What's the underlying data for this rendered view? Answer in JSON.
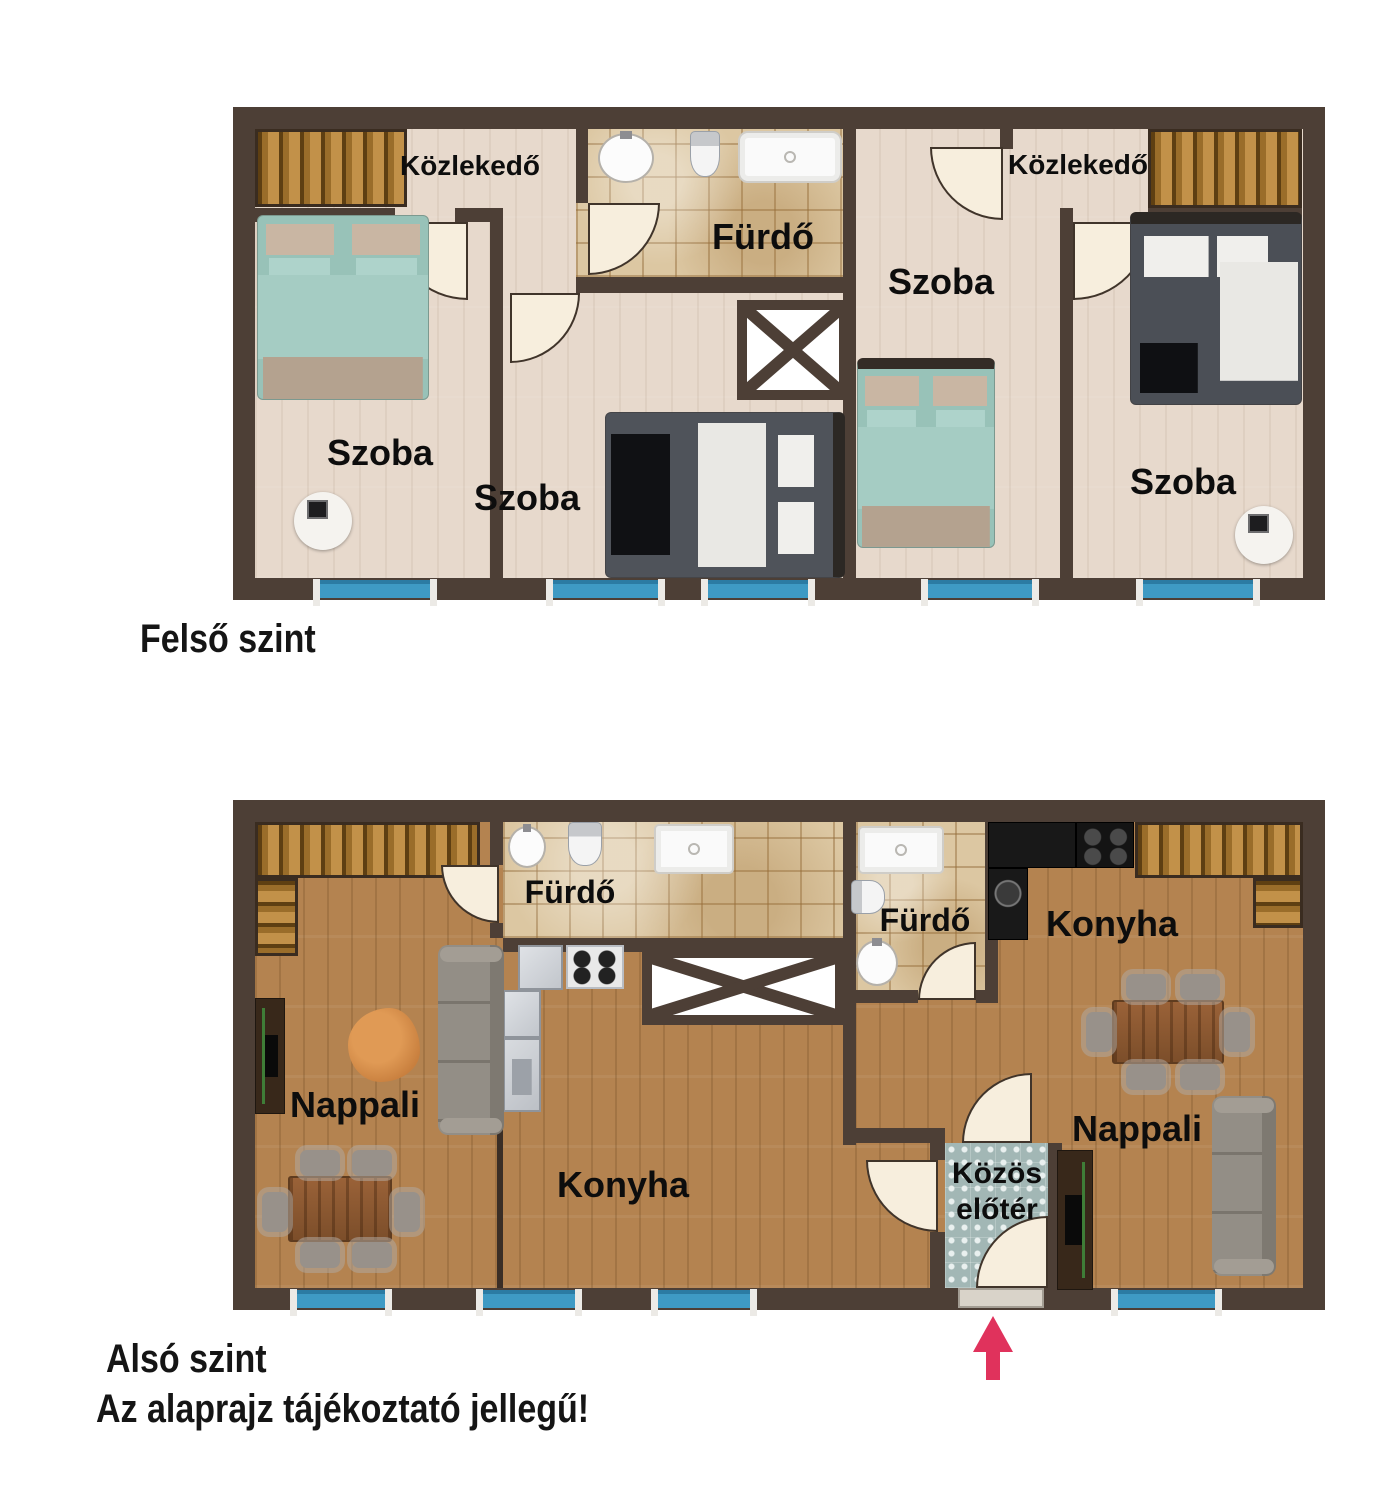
{
  "palette": {
    "wall": "#4d3f36",
    "floor_upper": "#e7d9cc",
    "floor_lower": "#b48350",
    "bath_tile": "#dcc7a2",
    "foyer_tile": "#a2b7b5",
    "window_blue": "#3e9ac4",
    "stair_wood": "#a9792f",
    "door_leaf": "#f7eedd",
    "arrow_pink": "#e0325c"
  },
  "floors": [
    {
      "id": "felso",
      "caption": "Felső szint",
      "rooms": [
        {
          "id": "kozlekedo-left",
          "label": "Közlekedő"
        },
        {
          "id": "furdo",
          "label": "Fürdő"
        },
        {
          "id": "szoba-left",
          "label": "Szoba"
        },
        {
          "id": "szoba-middle",
          "label": "Szoba"
        },
        {
          "id": "szoba-right-1",
          "label": "Szoba"
        },
        {
          "id": "kozlekedo-right",
          "label": "Közlekedő"
        },
        {
          "id": "szoba-right-2",
          "label": "Szoba"
        }
      ]
    },
    {
      "id": "also",
      "caption": "Alsó szint",
      "rooms": [
        {
          "id": "furdo-left",
          "label": "Fürdő"
        },
        {
          "id": "nappali-left",
          "label": "Nappali"
        },
        {
          "id": "konyha-left",
          "label": "Konyha"
        },
        {
          "id": "furdo-right",
          "label": "Fürdő"
        },
        {
          "id": "konyha-right",
          "label": "Konyha"
        },
        {
          "id": "nappali-right",
          "label": "Nappali"
        },
        {
          "id": "kozos-eloter",
          "label": "Közös",
          "label2": "előtér"
        }
      ]
    }
  ],
  "note": "Az alaprajz tájékoztató jellegű!"
}
